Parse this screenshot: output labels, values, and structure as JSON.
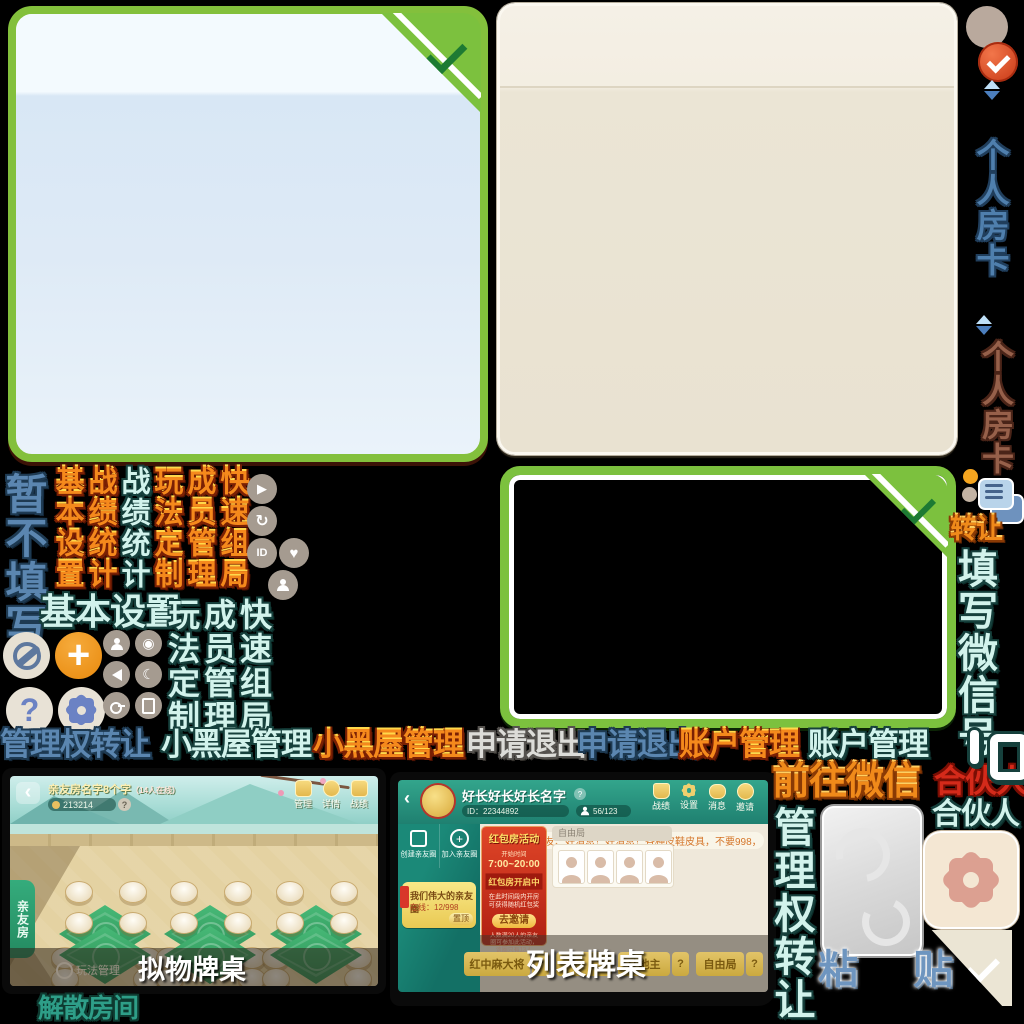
{
  "colors": {
    "panel_green": "#7CC13E",
    "panel_blue_bg": "#DEEAF6",
    "panel_beige_bg": "#EBE5D5",
    "check_green": "#1D7A33",
    "accent_orange": "#F0941D",
    "teal_header": "#2FA189",
    "banner_red": "#C5291A",
    "gold": "#E3B84E"
  },
  "icons": {
    "back": "‹",
    "question": "?",
    "plus": "+",
    "play": "▶",
    "history": "↻",
    "heart": "♥",
    "moon": "☾",
    "eye": "◉",
    "id_badge": "ID"
  },
  "label_row": {
    "admin_transfer_blue": "管理权转让",
    "blackroom_cyan": "小黑屋管理",
    "blackroom_red": "小黑屋管理",
    "quit_grey": "申请退出",
    "quit_blue": "申请退出",
    "account_red": "账户管理",
    "account_cyan": "账户管理"
  },
  "vertical": {
    "skip_fill": "暂不填写",
    "basic_red": "基本设置",
    "stats_red": "战绩统计",
    "stats_cyan": "战绩统计",
    "custom_red": "玩法定制",
    "member_red": "成员管理",
    "quick_red": "快速组局",
    "basic_cyan": "基本设置",
    "custom_cyan": "玩法定制",
    "member_cyan": "成员管理",
    "quick_cyan": "快速组局"
  },
  "right_rail": {
    "room_card_blue": "个人房卡",
    "room_card_brown": "个人房卡",
    "transfer": "转让",
    "fill_wechat": "填写微信号",
    "partner_red": "合伙人",
    "partner_cyan": "合伙人"
  },
  "bottom_right": {
    "go_wechat": "前往微信",
    "admin_transfer_vertical": "管理权转让",
    "paste": "粘 贴"
  },
  "dissolve_room": {
    "label": "解散房间"
  },
  "screenshot1": {
    "caption": "拟物牌桌",
    "room_name": "亲友房名字8个字",
    "online_suffix": "（14人在线）",
    "room_id": "213214",
    "header_buttons": [
      {
        "label": "管理"
      },
      {
        "label": "详情"
      },
      {
        "label": "战绩"
      },
      {
        "label": "邀请"
      }
    ],
    "side_tab": "亲友房",
    "manage_entry": "玩法管理"
  },
  "screenshot2": {
    "caption": "列表牌桌",
    "title": "好长好长好长名字",
    "room_id": "ID：22344892",
    "online_count": "56/123",
    "header_buttons": [
      {
        "label": "战绩"
      },
      {
        "label": "设置"
      },
      {
        "label": "消息"
      },
      {
        "label": "邀请"
      }
    ],
    "sidebar_buttons": [
      {
        "label": "创建亲友圈"
      },
      {
        "label": "加入亲友圈"
      }
    ],
    "circle_card": {
      "name": "我们伟大的亲友圈",
      "online": "在线：12/998",
      "pin": "置顶"
    },
    "announcement": "各位麻友、好消息！好消息！各种皮鞋皮具，不要998，不要688，只要98元，只要9",
    "banner": {
      "title": "红包房活动",
      "time_label": "开始时间",
      "time": "7:00~20:00",
      "status": "红包房开启中",
      "desc": "在此时间段内开房可获得随机红包奖",
      "button": "去邀请",
      "note": "人数满20人的亲友圈可参加此活动，该圈只有13人",
      "note2": "不符合参与条件"
    },
    "section": "自由局",
    "tabs": [
      {
        "label": "红中麻大将"
      },
      {
        "label": "斗地主"
      },
      {
        "label": "自由局"
      }
    ],
    "tab_help": "?"
  }
}
